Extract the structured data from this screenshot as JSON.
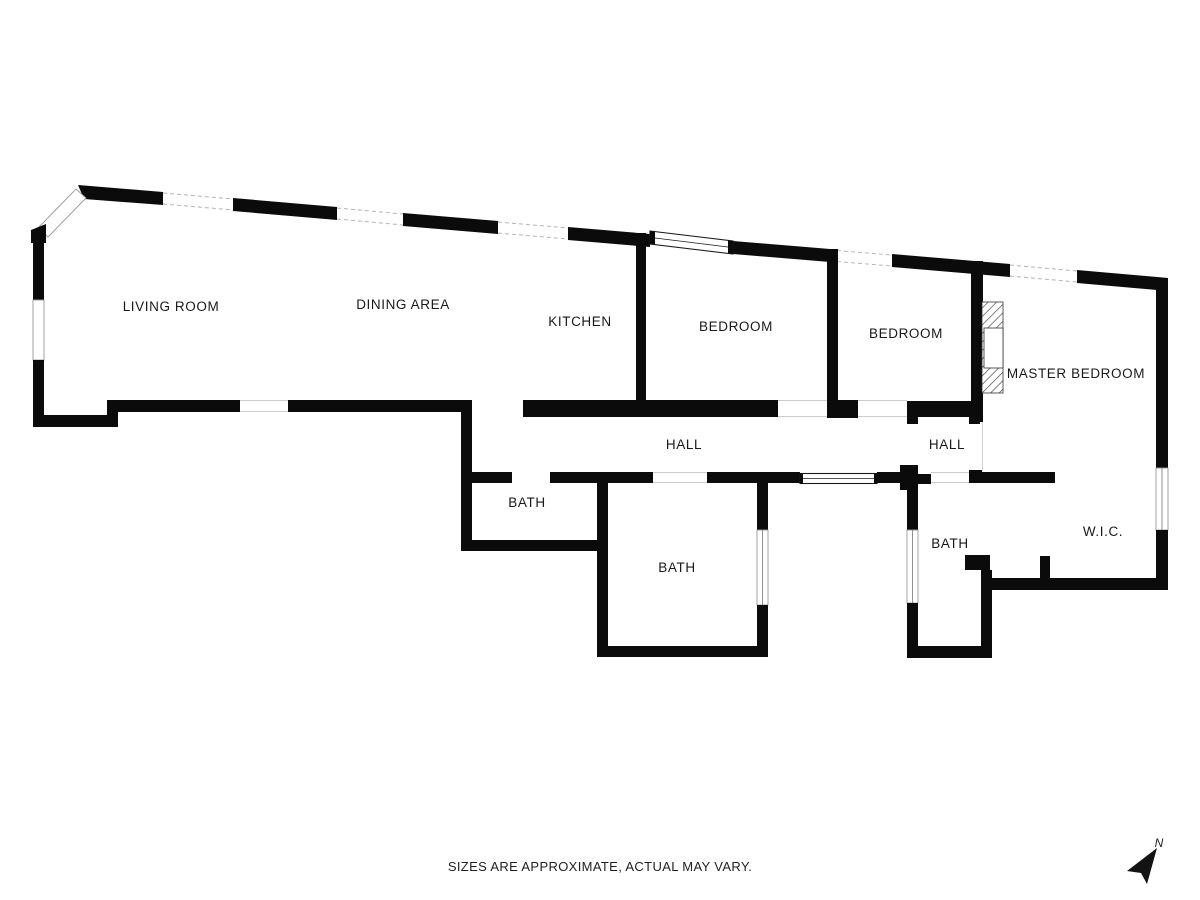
{
  "plan": {
    "wall_color": "#0b0b0b",
    "label_color": "#1a1a1a",
    "rooms": [
      {
        "id": "living-room",
        "label": "LIVING ROOM",
        "x": 171,
        "y": 311
      },
      {
        "id": "dining-area",
        "label": "DINING AREA",
        "x": 403,
        "y": 309
      },
      {
        "id": "kitchen",
        "label": "KITCHEN",
        "x": 580,
        "y": 326
      },
      {
        "id": "bedroom-1",
        "label": "BEDROOM",
        "x": 736,
        "y": 331
      },
      {
        "id": "bedroom-2",
        "label": "BEDROOM",
        "x": 906,
        "y": 338
      },
      {
        "id": "master-bedroom",
        "label": "MASTER BEDROOM",
        "x": 1076,
        "y": 378
      },
      {
        "id": "hall-1",
        "label": "HALL",
        "x": 684,
        "y": 449
      },
      {
        "id": "hall-2",
        "label": "HALL",
        "x": 947,
        "y": 449
      },
      {
        "id": "bath-1",
        "label": "BATH",
        "x": 527,
        "y": 507
      },
      {
        "id": "bath-2",
        "label": "BATH",
        "x": 677,
        "y": 572
      },
      {
        "id": "bath-3",
        "label": "BATH",
        "x": 950,
        "y": 548
      },
      {
        "id": "wic",
        "label": "W.I.C.",
        "x": 1103,
        "y": 536
      }
    ],
    "north_label": "N"
  },
  "footer": {
    "disclaimer": "SIZES ARE APPROXIMATE, ACTUAL MAY VARY."
  }
}
